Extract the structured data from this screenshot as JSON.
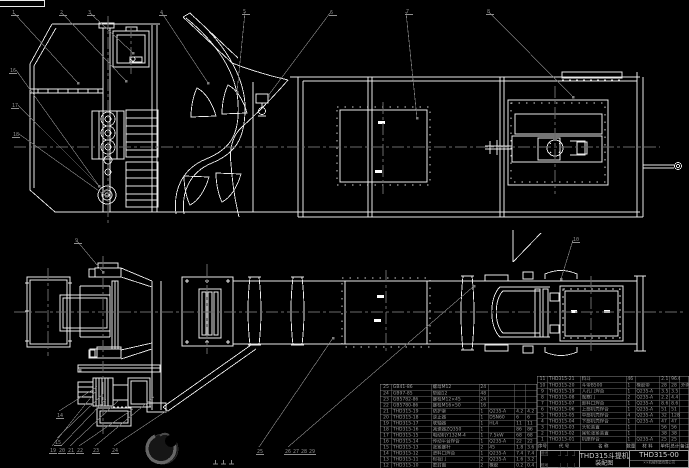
{
  "meta": {
    "background_color": "#000000",
    "line_color": "#e9e9e9",
    "leader_color": "#7d7d7d",
    "centerline_color": "#6a6a6a",
    "table_text_color": "#9f9f9f"
  },
  "title_block": {
    "product_title": "THD315斗提机",
    "drawing_type": "装配图",
    "drawing_number": "THD315-00",
    "company": "××机械制造有限公司",
    "sign_labels": [
      "设计",
      "校对",
      "审核"
    ]
  },
  "bom_header": [
    "序号",
    "代  号",
    "名  称",
    "数量",
    "材 料",
    "单件",
    "总计",
    "备注"
  ],
  "bom_right_rows": [
    [
      "11",
      "THD315-21",
      "料斗",
      "46",
      "",
      "2.1",
      "96.6",
      ""
    ],
    [
      "10",
      "THD315-20",
      "斗带B500",
      "1",
      "橡胶带",
      "28",
      "28",
      "外购"
    ],
    [
      "9",
      "THD315-19",
      "人孔门焊合",
      "1",
      "Q235-A",
      "3.5",
      "3.5",
      ""
    ],
    [
      "8",
      "THD315-08",
      "观察门",
      "2",
      "Q235-A",
      "2.2",
      "4.4",
      ""
    ],
    [
      "7",
      "THD315-07",
      "卸料口焊合",
      "1",
      "Q235-A",
      "8.6",
      "8.6",
      ""
    ],
    [
      "6",
      "THD315-06",
      "上部机壳焊合",
      "1",
      "Q235-A",
      "51",
      "51",
      ""
    ],
    [
      "5",
      "THD315-05",
      "中部机壳焊合",
      "4",
      "Q235-A",
      "32",
      "128",
      ""
    ],
    [
      "4",
      "THD315-04",
      "下部机壳焊合",
      "1",
      "Q235-A",
      "47",
      "47",
      ""
    ],
    [
      "3",
      "THD315-03",
      "头轮装置",
      "1",
      "",
      "56",
      "56",
      ""
    ],
    [
      "2",
      "THD315-02",
      "尾轮张紧装置",
      "1",
      "",
      "38",
      "38",
      ""
    ],
    [
      "1",
      "THD315-01",
      "机座焊合",
      "1",
      "Q235-A",
      "25",
      "25",
      ""
    ]
  ],
  "bom_left_rows": [
    [
      "25",
      "GB41-86",
      "螺母M12",
      "24",
      "",
      "",
      ""
    ],
    [
      "24",
      "GB97-85",
      "垫圈12",
      "48",
      "",
      "",
      ""
    ],
    [
      "23",
      "GB5782-86",
      "螺栓M12×45",
      "24",
      "",
      "",
      ""
    ],
    [
      "22",
      "GB5780-86",
      "螺栓M16×50",
      "16",
      "",
      "",
      ""
    ],
    [
      "21",
      "THD315-19",
      "防护罩",
      "1",
      "Q235-A",
      "4.2",
      "4.2"
    ],
    [
      "20",
      "THD315-18",
      "逆止器",
      "1",
      "DSN60",
      "6",
      "6"
    ],
    [
      "19",
      "THD315-17",
      "联轴器",
      "1",
      "HL4",
      "11",
      "11"
    ],
    [
      "18",
      "THD315-16",
      "减速器ZQ350",
      "1",
      "",
      "86",
      "86"
    ],
    [
      "17",
      "THD315-15",
      "电动机Y132M-4",
      "1",
      "7.5kW",
      "68",
      "68"
    ],
    [
      "16",
      "THD315-14",
      "传动平台焊合",
      "1",
      "Q235-A",
      "22",
      "22"
    ],
    [
      "15",
      "THD315-13",
      "张紧螺杆",
      "2",
      "45",
      "1.8",
      "3.6"
    ],
    [
      "14",
      "THD315-12",
      "进料口焊合",
      "1",
      "Q235-A",
      "7.4",
      "7.4"
    ],
    [
      "13",
      "THD315-11",
      "检视门",
      "2",
      "Q235-A",
      "1.6",
      "3.2"
    ],
    [
      "12",
      "THD315-10",
      "密封圈",
      "2",
      "橡胶",
      "0.2",
      "0.4"
    ]
  ],
  "callouts": {
    "top": [
      "1",
      "2",
      "3",
      "4",
      "5",
      "6",
      "7",
      "8"
    ],
    "plan_top": [
      "9",
      "10"
    ],
    "left": [
      "16",
      "17",
      "18"
    ],
    "side_left": [
      "14",
      "15"
    ],
    "bottom_left": [
      "19",
      "20",
      "21",
      "22",
      "23",
      "24"
    ],
    "bottom_mid": [
      "25",
      "26",
      "27",
      "28",
      "29"
    ]
  }
}
